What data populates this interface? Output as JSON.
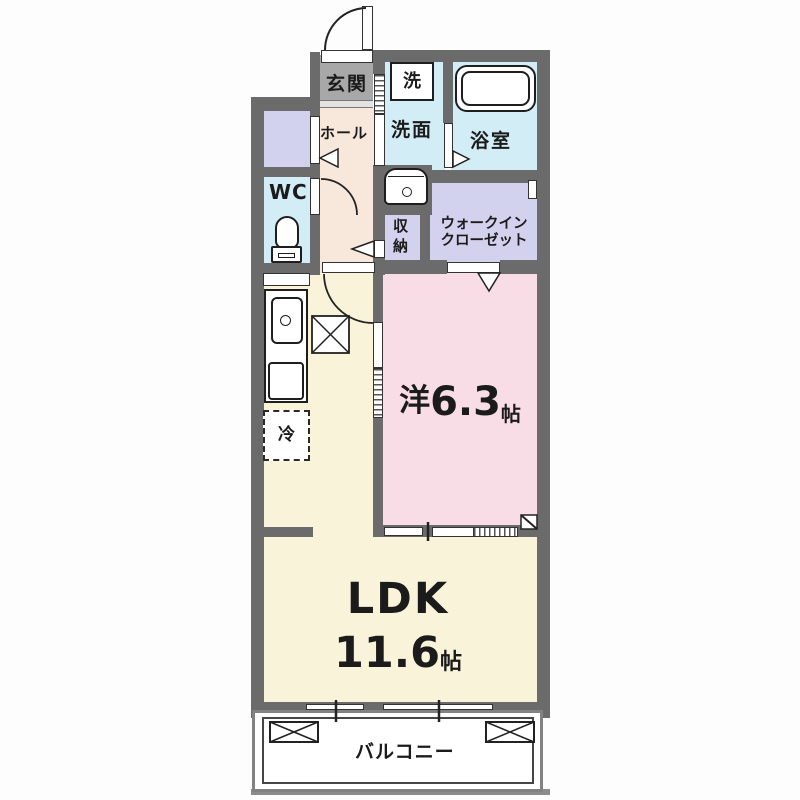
{
  "plan": {
    "type": "apartment-floor-plan",
    "rooms": {
      "genkan": "玄関",
      "hall": "ホール",
      "washer": "洗",
      "senmen": "洗面",
      "bathroom": "浴室",
      "wc": "WC",
      "storage": "収納",
      "wic_lines": [
        "ウォークイン",
        "クローゼット"
      ],
      "western_room": {
        "prefix": "洋",
        "size": "6.3",
        "unit": "帖"
      },
      "ldk": {
        "name": "LDK",
        "size": "11.6",
        "unit": "帖"
      },
      "balcony": "バルコニー",
      "fridge": "冷"
    }
  },
  "colors": {
    "wall": "#6b6b6b",
    "genkan_floor": "#a8a8a8",
    "hall_floor": "#f8e8dc",
    "wet_room": "#d2edf5",
    "closet": "#d2d2ee",
    "bedroom": "#f8dde6",
    "ldk_floor": "#f9f3da",
    "line": "#222222"
  }
}
